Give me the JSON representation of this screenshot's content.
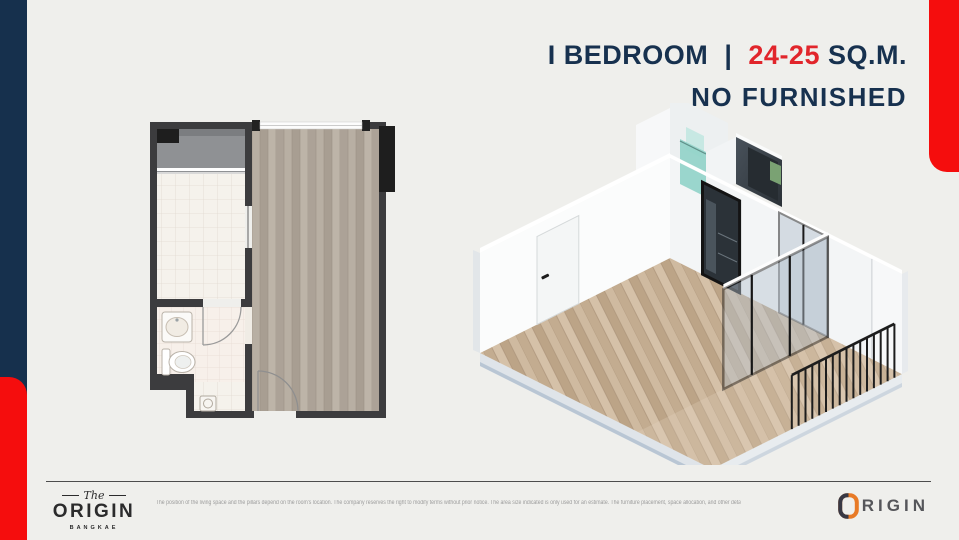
{
  "page": {
    "background": "#efefec",
    "accent_navy": "#16304d",
    "accent_red": "#f50d0d",
    "title_red": "#e1252b"
  },
  "header": {
    "bedroom_label": "I BEDROOM",
    "divider": "|",
    "area_value": "24-25",
    "area_unit": "SQ.M.",
    "furnish_label": "NO FURNISHED"
  },
  "footer": {
    "brand": {
      "prefix": "The",
      "name": "ORIGIN",
      "location": "BANGKAE"
    },
    "disclaimer": "The position of the living space and the pillars depend on the room's location. The company reserves the right to modify terms without prior notice. The area size indicated is only used for an estimate. The furniture placement, space allocation, and other details are used for advertising purposes only.",
    "logo_text": "RIGIN"
  }
}
